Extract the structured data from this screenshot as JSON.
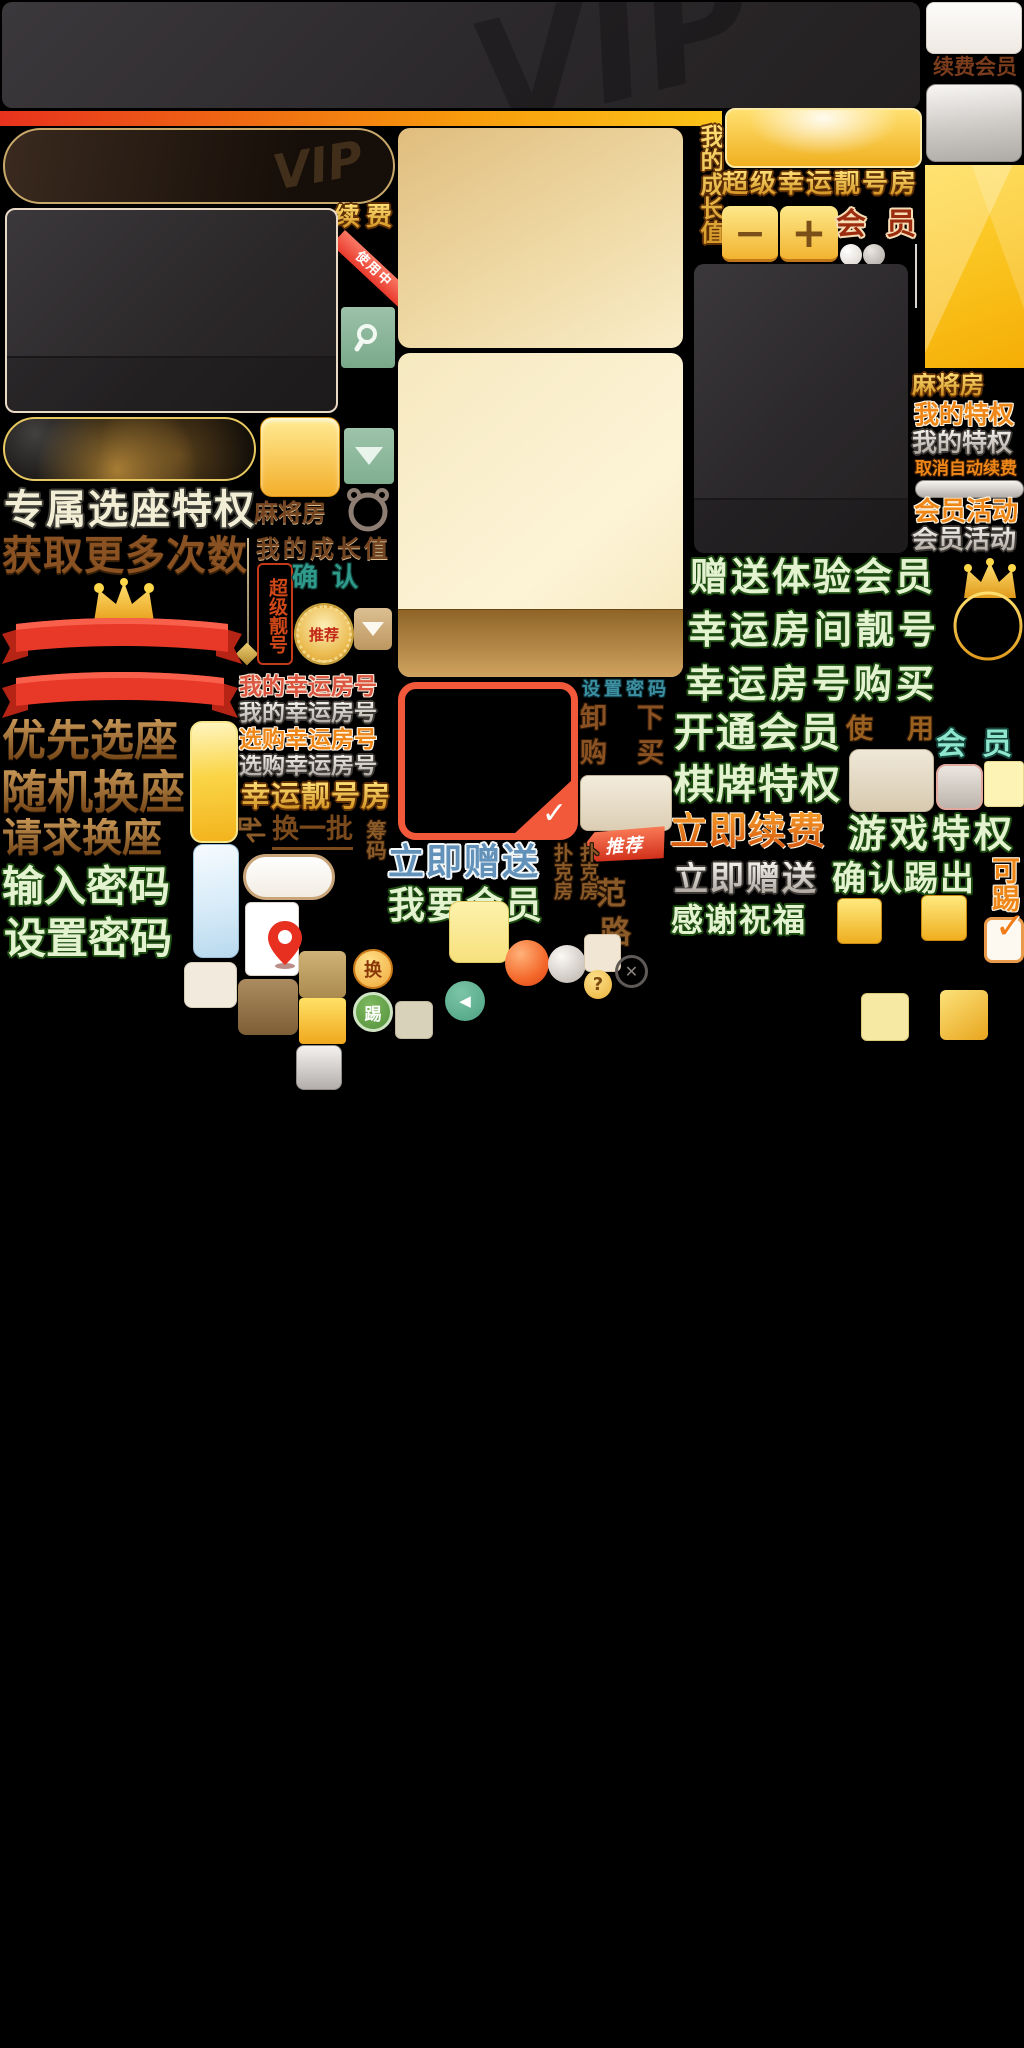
{
  "canvas": {
    "width": 1024,
    "height": 2048,
    "background": "#000000"
  },
  "palette": {
    "gold": "#f7c437",
    "dark_panel": "#2e2b2d",
    "red_ribbon": "#e93a2c",
    "orange_text": "#ef8718",
    "green_fill": "#e3f2cf",
    "green_outline": "#1e4d12",
    "teal": "#2f9a8c",
    "brown": "#8a5a28",
    "silver": "#cfc9c2",
    "tan_panel": "#efd9a5",
    "blue_label": "#6292ba"
  },
  "top": {
    "vip_watermark": "VIP",
    "renew_member_label": "续费会员",
    "renew_label": "续费",
    "in_use_ribbon": "使用中",
    "growth_value_vertical": "我的成长值",
    "super_lucky_room_title": "超级幸运靓号房",
    "member_label": "会员",
    "minus_glyph": "−",
    "plus_glyph": "+"
  },
  "left": {
    "exclusive_seat": "专属选座特权",
    "get_more_times": "获取更多次数",
    "priority_seat": "优先选座",
    "random_swap_seat": "随机换座",
    "request_swap_seat": "请求换座",
    "enter_password": "输入密码",
    "set_password": "设置密码",
    "mahjong_room": "麻将房",
    "my_growth_value": "我的成长值",
    "confirm": "确认",
    "super_number_stamp": "超级靓号",
    "recommend_medal": "推荐"
  },
  "middle": {
    "my_lucky_room_red": "我的幸运房号",
    "my_lucky_room_silver": "我的幸运房号",
    "buy_lucky_room_orange": "选购幸运房号",
    "buy_lucky_room_silver": "选购幸运房号",
    "lucky_number_room": "幸运靓号房",
    "change_batch": "换一批",
    "chips_vertical": "筹码",
    "set_password_small": "设置密码",
    "unload": "卸下",
    "buy": "购买",
    "recommend_tag": "推荐",
    "gift_now_blue": "立即赠送",
    "want_member": "我要会员",
    "poker_room_col1": "扑克房",
    "poker_room_col2": "扑克房",
    "char_fan": "范",
    "char_lu": "路"
  },
  "right": {
    "mahjong_room": "麻将房",
    "my_privilege_orange": "我的特权",
    "my_privilege_silver": "我的特权",
    "cancel_auto_renew": "取消自动续费",
    "member_activity_orange": "会员活动",
    "member_activity_silver": "会员活动",
    "gift_trial_member": "赠送体验会员",
    "lucky_room_number": "幸运房间靓号",
    "lucky_number_purchase": "幸运房号购买",
    "open_member": "开通会员",
    "use_label": "使用",
    "member_teal": "会员",
    "board_game_privilege": "棋牌特权",
    "renew_now": "立即续费",
    "game_privilege": "游戏特权",
    "gift_now_gray": "立即赠送",
    "confirm_kick_out": "确认踢出",
    "kickable_vertical": "可踢",
    "thanks_blessing": "感谢祝福"
  },
  "icons": {
    "down_triangle": "▼",
    "checkmark": "✓",
    "close_x": "✕",
    "question_mark": "?",
    "left_arrow": "◀",
    "swap_glyph": "换",
    "kick_glyph": "踢"
  }
}
